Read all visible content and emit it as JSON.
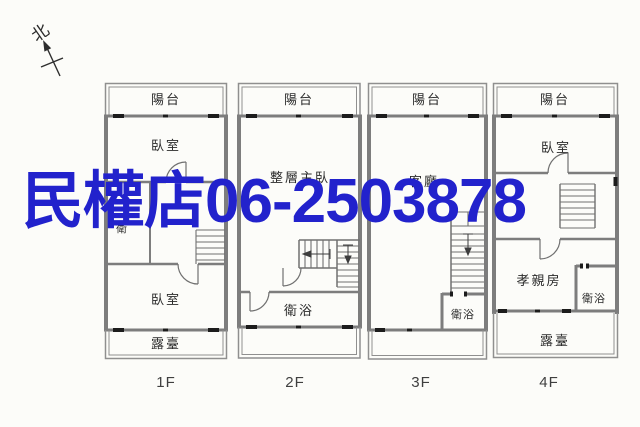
{
  "compass": {
    "label": "北"
  },
  "watermark": {
    "text": "民權店06-2503878",
    "color": "#2222cc"
  },
  "floors": [
    {
      "label": "1F",
      "rooms": {
        "balcony": "陽台",
        "bedroom_front": "臥室",
        "bath": "衛",
        "bedroom_rear": "臥室",
        "terrace": "露臺"
      }
    },
    {
      "label": "2F",
      "rooms": {
        "balcony": "陽台",
        "master_bedroom": "整層主臥",
        "bath": "衛浴"
      }
    },
    {
      "label": "3F",
      "rooms": {
        "balcony": "陽台",
        "living_room": "客廳",
        "bath": "衛浴"
      }
    },
    {
      "label": "4F",
      "rooms": {
        "balcony": "陽台",
        "bedroom": "臥室",
        "parents_room": "孝親房",
        "bath": "衛浴",
        "terrace": "露臺"
      }
    }
  ]
}
